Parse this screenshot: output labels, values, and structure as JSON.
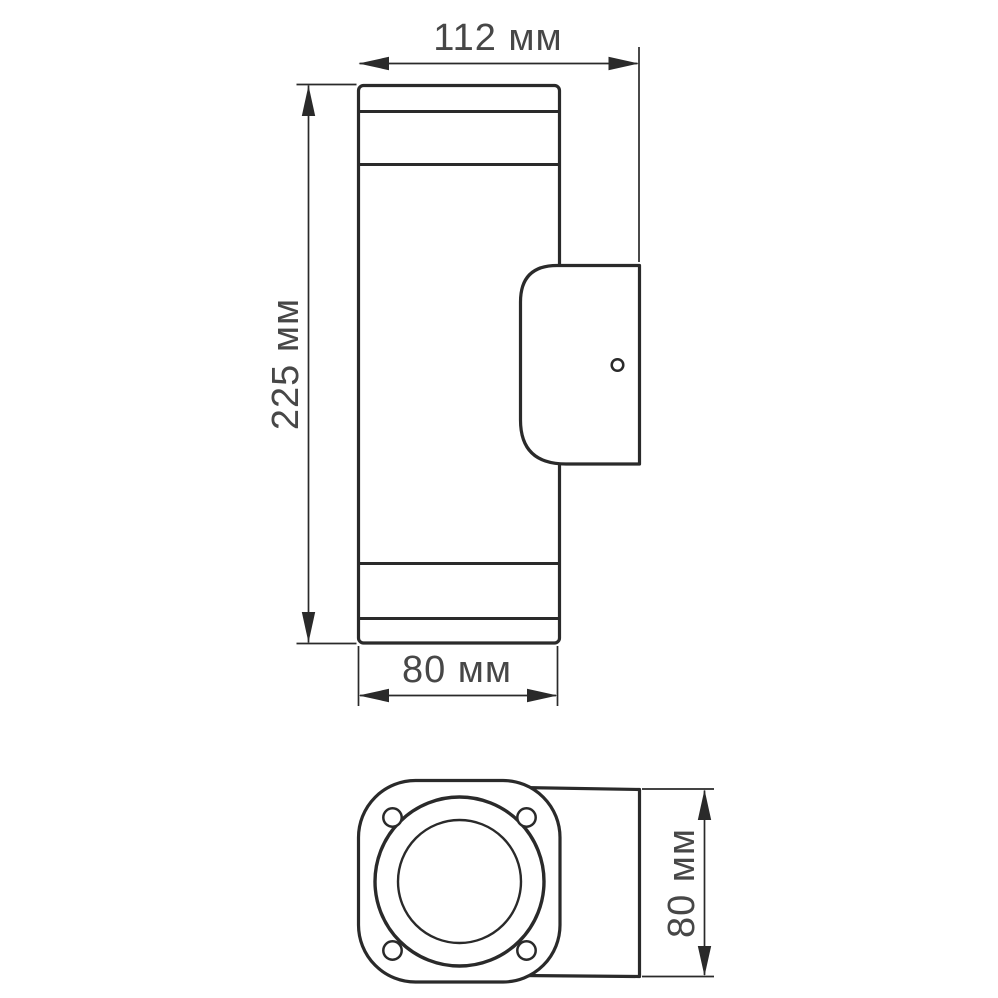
{
  "figure": {
    "background_color": "#ffffff",
    "line_color": "#2a2a2a",
    "text_color": "#474747",
    "side_view": {
      "description": "side view of cylindrical up-down wall luminaire with wall-mount bracket",
      "dim_depth": {
        "label": "112 мм",
        "value": 112,
        "unit": "мм",
        "orientation": "horizontal"
      },
      "dim_height": {
        "label": "225 мм",
        "value": 225,
        "unit": "мм",
        "orientation": "vertical"
      },
      "dim_body_width": {
        "label": "80 мм",
        "value": 80,
        "unit": "мм",
        "orientation": "horizontal"
      }
    },
    "bottom_view": {
      "description": "bottom view of lens flange with four screws and mounting arm",
      "dim_mount_width": {
        "label": "80 мм",
        "value": 80,
        "unit": "мм",
        "orientation": "vertical"
      }
    }
  }
}
